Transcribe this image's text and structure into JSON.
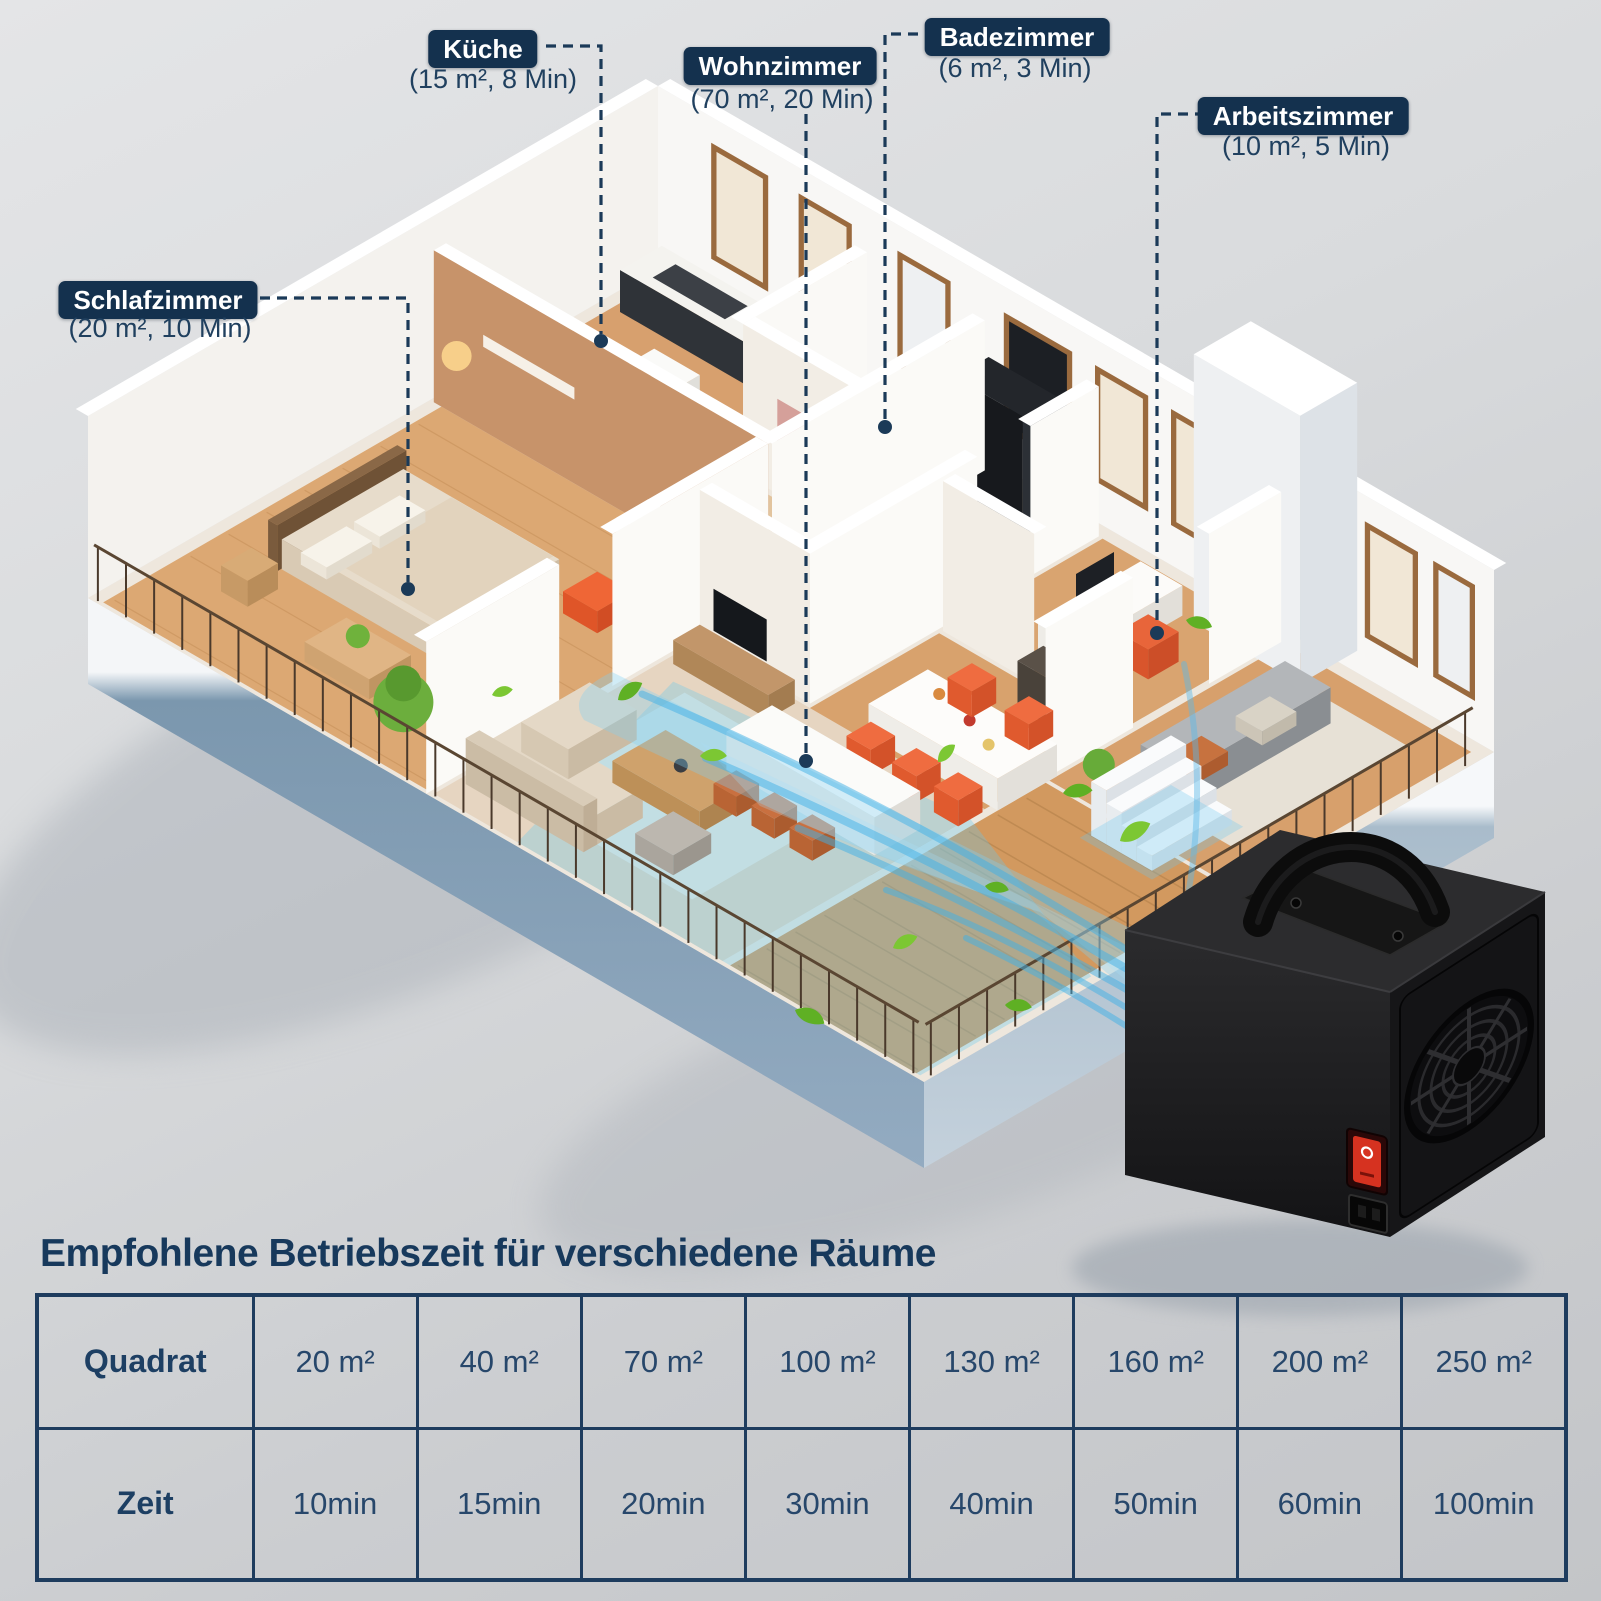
{
  "room_labels": [
    {
      "name": "Küche",
      "detail": "(15 m², 8 Min)"
    },
    {
      "name": "Wohnzimmer",
      "detail": "(70 m², 20 Min)"
    },
    {
      "name": "Badezimmer",
      "detail": "(6 m², 3 Min)"
    },
    {
      "name": "Arbeitszimmer",
      "detail": "(10 m², 5 Min)"
    },
    {
      "name": "Schlafzimmer",
      "detail": "(20 m², 10 Min)"
    }
  ],
  "section": {
    "heading": "Empfohlene Betriebszeit für verschiedene Räume"
  },
  "table": {
    "rows": [
      {
        "header": "Quadrat",
        "cells": [
          "20 m²",
          "40 m²",
          "70 m²",
          "100 m²",
          "130 m²",
          "160 m²",
          "200 m²",
          "250 m²"
        ]
      },
      {
        "header": "Zeit",
        "cells": [
          "10min",
          "15min",
          "20min",
          "30min",
          "40min",
          "50min",
          "60min",
          "100min"
        ]
      }
    ]
  },
  "colors": {
    "badge_navy": "#14314e",
    "heading_navy": "#17395c",
    "table_border_navy": "#1e3c5e",
    "leader_line": "#1b3a58",
    "air_flow_blue": "#3fb0e6",
    "leaf_green": "#74c12f",
    "machine_black": "#1b1b1d",
    "power_switch_red": "#d63220"
  }
}
